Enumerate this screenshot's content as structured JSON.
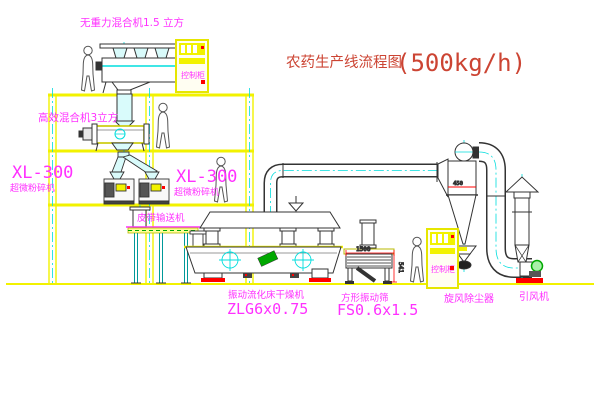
{
  "title": {
    "name_cn": "农药生产线流程图",
    "capacity": "(500kg/h)"
  },
  "labels": {
    "gravity_mixer": "无重力混合机1.5 立方",
    "high_eff_mixer": "高效混合机3立方",
    "mill_left_model": "XL-300",
    "mill_left_name": "超微粉碎机",
    "mill_right_model": "XL-300",
    "mill_right_name": "超微粉碎机",
    "belt_conveyor": "皮带输送机",
    "dryer_name": "振动流化床干燥机",
    "dryer_model": "ZLG6x0.75",
    "screen_name": "方形振动筛",
    "screen_model": "FS0.6x1.5",
    "cyclone": "旋风除尘器",
    "fan": "引风机",
    "cabinet_top": "控制柜",
    "cabinet_right": "控制柜"
  },
  "dimensions": {
    "screen_length": "1500",
    "screen_height": "541",
    "cyclone_width": "450"
  },
  "colors": {
    "structure_yellow": "#f2f200",
    "drawing_line": "#333333",
    "centerline_cyan": "#00dddd",
    "label_magenta": "#ff30ff",
    "title_red": "#cc4433",
    "accent_red": "#ff0000",
    "accent_green": "#00a800"
  }
}
